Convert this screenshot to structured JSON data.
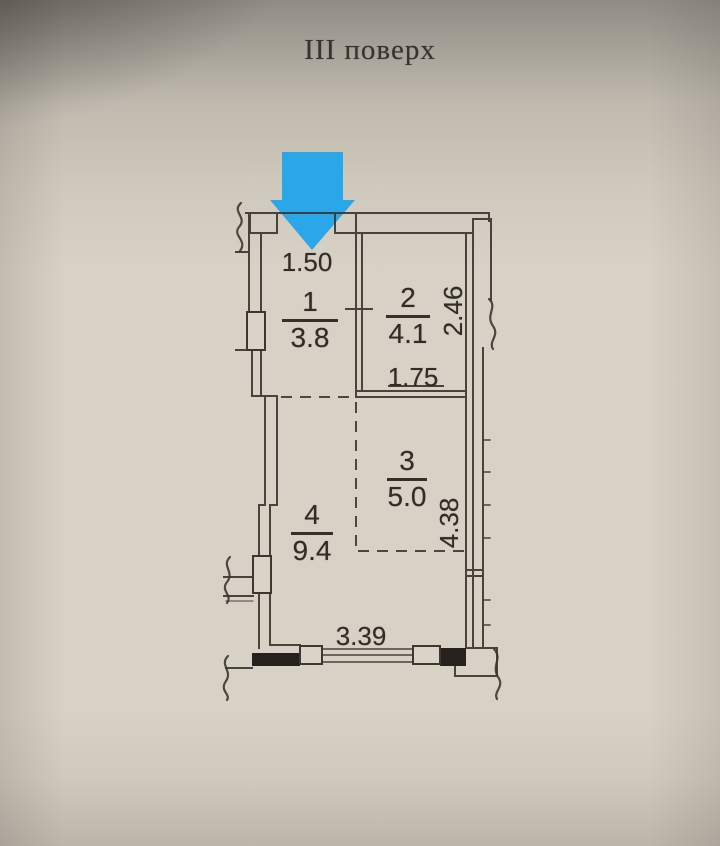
{
  "title": "III поверх",
  "floor_plan": {
    "arrow_color": "#2aa7e8",
    "rooms": [
      {
        "number": "1",
        "area": "3.8"
      },
      {
        "number": "2",
        "area": "4.1"
      },
      {
        "number": "3",
        "area": "5.0"
      },
      {
        "number": "4",
        "area": "9.4"
      }
    ],
    "dimensions": {
      "entry_width": "1.50",
      "room2_depth": "2.46",
      "room2_width": "1.75",
      "room3_depth": "4.38",
      "bottom_width": "3.39"
    }
  }
}
